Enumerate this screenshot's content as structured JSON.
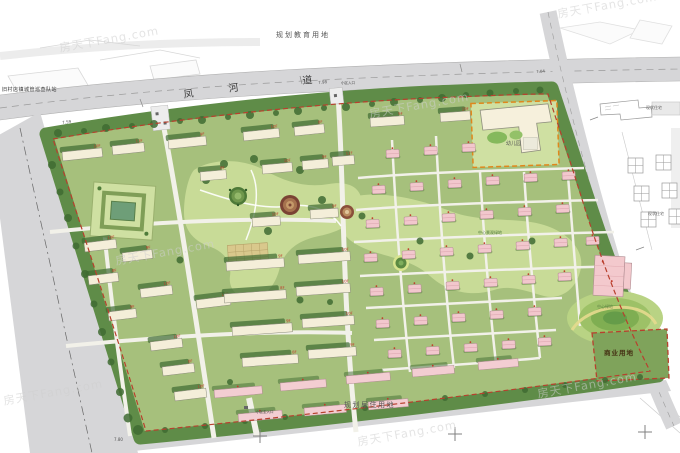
{
  "labels": {
    "planning_education": "规划教育用地",
    "planning_residential": "规划居住用地",
    "commercial_land": "商业用地",
    "kindergarten": "幼儿园",
    "station": "旧村店镇城管巡查队站",
    "existing_top": "现状住宅",
    "existing_bottom": "现状住宅",
    "entrance_main": "小区主入口",
    "entrance_north": "小区入口",
    "central_green": "中心景观绿地",
    "hill_green": "中心绿地"
  },
  "road": {
    "name": "凤河道",
    "name_chars": [
      {
        "ch": "凤",
        "x": 183,
        "y": 91,
        "rot": -8
      },
      {
        "ch": "河",
        "x": 228,
        "y": 85,
        "rot": -8
      },
      {
        "ch": "道",
        "x": 302,
        "y": 77,
        "rot": -6
      }
    ]
  },
  "elevations": [
    {
      "v": "7.59",
      "x": 62,
      "y": 121,
      "rot": -8
    },
    {
      "v": "7.98",
      "x": 318,
      "y": 81,
      "rot": -6
    },
    {
      "v": "7.04",
      "x": 536,
      "y": 70,
      "rot": -4
    },
    {
      "v": "7.80",
      "x": 114,
      "y": 438,
      "rot": 0
    }
  ],
  "watermark": {
    "text": "房天下Fang.com",
    "positions": [
      [
        58,
        40
      ],
      [
        556,
        6
      ],
      [
        368,
        106
      ],
      [
        114,
        253
      ],
      [
        2,
        393
      ],
      [
        356,
        434
      ],
      [
        536,
        386
      ]
    ]
  },
  "map": {
    "colors": {
      "tree": "#3f6b32",
      "slab": "#f4eed9",
      "pink": "#f3cdd2",
      "villa": "#f2c7cd",
      "red_label": "#c03a2a",
      "boundary_red": "#b8402e",
      "kinder_orange": "#e0871c",
      "site_green": "#a6c07c",
      "band_green": "#5f8c48",
      "road_gray": "#d6d6d8"
    },
    "floor_tags": [
      "10F",
      "9F",
      "8F",
      "11F"
    ],
    "slabs": [
      [
        62,
        152,
        40,
        -6,
        0
      ],
      [
        112,
        146,
        32,
        -6,
        3
      ],
      [
        168,
        140,
        38,
        -6,
        1
      ],
      [
        243,
        132,
        36,
        -6,
        0
      ],
      [
        294,
        127,
        30,
        -6,
        2
      ],
      [
        370,
        118,
        34,
        -4,
        1
      ],
      [
        440,
        113,
        30,
        -4,
        0
      ],
      [
        200,
        172,
        26,
        -5,
        2
      ],
      [
        262,
        165,
        30,
        -5,
        0
      ],
      [
        302,
        161,
        26,
        -5,
        1
      ],
      [
        332,
        157,
        22,
        -5,
        3
      ],
      [
        252,
        218,
        28,
        -4,
        0
      ],
      [
        310,
        210,
        28,
        -4,
        1
      ],
      [
        84,
        243,
        32,
        -7,
        0
      ],
      [
        122,
        253,
        30,
        -7,
        1
      ],
      [
        88,
        276,
        30,
        -7,
        2
      ],
      [
        140,
        289,
        32,
        -7,
        0
      ],
      [
        108,
        312,
        28,
        -7,
        1
      ],
      [
        150,
        342,
        32,
        -7,
        0
      ],
      [
        162,
        367,
        32,
        -7,
        2
      ],
      [
        174,
        392,
        32,
        -7,
        0
      ],
      [
        196,
        300,
        34,
        -7,
        3
      ],
      [
        226,
        262,
        58,
        -4,
        1
      ],
      [
        298,
        255,
        52,
        -4,
        0
      ],
      [
        224,
        294,
        62,
        -4,
        2
      ],
      [
        296,
        287,
        54,
        -4,
        0
      ],
      [
        232,
        327,
        60,
        -4,
        1
      ],
      [
        302,
        319,
        52,
        -4,
        0
      ],
      [
        242,
        358,
        56,
        -4,
        2
      ],
      [
        308,
        350,
        48,
        -4,
        1
      ]
    ],
    "pink_slabs": [
      [
        214,
        390,
        48,
        -5
      ],
      [
        280,
        383,
        46,
        -5
      ],
      [
        346,
        376,
        44,
        -5
      ],
      [
        412,
        369,
        42,
        -5
      ],
      [
        478,
        362,
        40,
        -5
      ],
      [
        238,
        414,
        44,
        -5
      ],
      [
        304,
        408,
        42,
        -5
      ],
      [
        368,
        402,
        40,
        -5
      ]
    ],
    "villas": [
      [
        386,
        150
      ],
      [
        424,
        147
      ],
      [
        462,
        144
      ],
      [
        372,
        186
      ],
      [
        410,
        183
      ],
      [
        448,
        180
      ],
      [
        486,
        177
      ],
      [
        524,
        174
      ],
      [
        562,
        172
      ],
      [
        366,
        220
      ],
      [
        404,
        217
      ],
      [
        442,
        214
      ],
      [
        480,
        211
      ],
      [
        518,
        208
      ],
      [
        556,
        205
      ],
      [
        364,
        254
      ],
      [
        402,
        251
      ],
      [
        440,
        248
      ],
      [
        478,
        245
      ],
      [
        516,
        242
      ],
      [
        554,
        239
      ],
      [
        586,
        237
      ],
      [
        370,
        288
      ],
      [
        408,
        285
      ],
      [
        446,
        282
      ],
      [
        484,
        279
      ],
      [
        522,
        276
      ],
      [
        558,
        273
      ],
      [
        376,
        320
      ],
      [
        414,
        317
      ],
      [
        452,
        314
      ],
      [
        490,
        311
      ],
      [
        528,
        308
      ],
      [
        388,
        350
      ],
      [
        426,
        347
      ],
      [
        464,
        344
      ],
      [
        502,
        341
      ],
      [
        538,
        338
      ]
    ],
    "trees": [
      [
        58,
        133,
        4
      ],
      [
        84,
        131,
        3
      ],
      [
        106,
        128,
        4
      ],
      [
        132,
        126,
        3
      ],
      [
        154,
        124,
        4
      ],
      [
        180,
        121,
        3
      ],
      [
        202,
        120,
        4
      ],
      [
        228,
        117,
        3
      ],
      [
        250,
        115,
        4
      ],
      [
        276,
        113,
        3
      ],
      [
        298,
        111,
        4
      ],
      [
        324,
        108,
        3
      ],
      [
        346,
        107,
        4
      ],
      [
        372,
        104,
        3
      ],
      [
        394,
        102,
        4
      ],
      [
        420,
        100,
        3
      ],
      [
        442,
        98,
        4
      ],
      [
        466,
        95,
        3
      ],
      [
        490,
        93,
        3.5
      ],
      [
        516,
        91,
        3
      ],
      [
        540,
        90,
        3.5
      ],
      [
        52,
        165,
        4
      ],
      [
        60,
        192,
        3.5
      ],
      [
        68,
        218,
        4
      ],
      [
        76,
        246,
        3.5
      ],
      [
        85,
        274,
        4
      ],
      [
        94,
        304,
        3.5
      ],
      [
        102,
        332,
        4
      ],
      [
        111,
        362,
        3.5
      ],
      [
        120,
        392,
        4
      ],
      [
        128,
        418,
        4.5
      ],
      [
        138,
        430,
        5
      ],
      [
        165,
        430,
        3
      ],
      [
        205,
        426,
        3
      ],
      [
        245,
        421,
        3
      ],
      [
        285,
        417,
        3
      ],
      [
        325,
        412,
        3
      ],
      [
        365,
        408,
        3
      ],
      [
        405,
        403,
        3
      ],
      [
        445,
        398,
        3
      ],
      [
        485,
        394,
        3
      ],
      [
        525,
        390,
        3
      ],
      [
        565,
        385,
        3
      ],
      [
        605,
        380,
        3
      ],
      [
        640,
        377,
        3
      ],
      [
        206,
        180,
        4
      ],
      [
        224,
        164,
        4
      ],
      [
        254,
        159,
        4
      ],
      [
        300,
        170,
        4
      ],
      [
        322,
        200,
        4
      ],
      [
        268,
        231,
        4
      ],
      [
        362,
        216,
        3.5
      ],
      [
        420,
        241,
        3.5
      ],
      [
        470,
        256,
        3.5
      ],
      [
        532,
        241,
        3.5
      ],
      [
        300,
        300,
        3.5
      ],
      [
        180,
        260,
        3.5
      ],
      [
        230,
        382,
        3
      ],
      [
        330,
        302,
        3
      ]
    ],
    "crosses": [
      [
        260,
        436
      ],
      [
        455,
        434
      ],
      [
        645,
        432
      ]
    ]
  }
}
